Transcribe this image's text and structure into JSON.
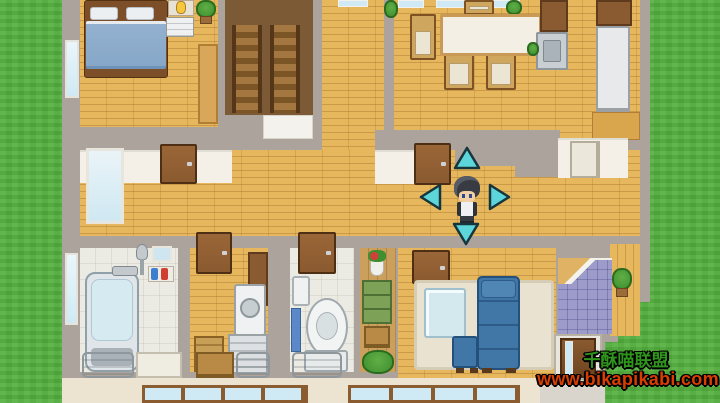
{
  "scene": {
    "description": "Top-down RPG-style house interior map with a player character standing in the central hallway and four movement arrows around him"
  },
  "watermark": {
    "line1": "千酥喵联盟",
    "line2": "www.bikapikabi.com"
  },
  "controls": {
    "move_arrows": [
      "up",
      "left",
      "right",
      "down"
    ]
  },
  "colors": {
    "grass": "#54b13e",
    "wall": "#aba39c",
    "whiteWall": "#f4f0e8",
    "wood": "#e6b75c",
    "darkFloor": "#7b5a35",
    "door": "#8a5a30",
    "doorFrame": "#4f2f14",
    "window": "#cfeaf5",
    "bed": "#87a7c8",
    "bedFrame": "#7c4f28",
    "tubWater": "#d6eaf2",
    "silver": "#ccd1d4",
    "fridge": "#e7e9ea",
    "sofa": "#4077a6",
    "rug": "#e9e2d1",
    "tile": "#9d9bca",
    "basket": "#c79f56",
    "shelfGreen": "#7da257",
    "plant": "#3f8f30",
    "exterior": "#ece4d0",
    "pavement": "#d9d5cc",
    "arrow": "#5cd6db",
    "arrowOutline": "#16363c",
    "wmGreen": "#2f941c",
    "wmRed": "#da3e00",
    "hair": "#383b42",
    "skin": "#f2cfa5",
    "shirt": "#eef0f2",
    "pants": "#363a42"
  }
}
